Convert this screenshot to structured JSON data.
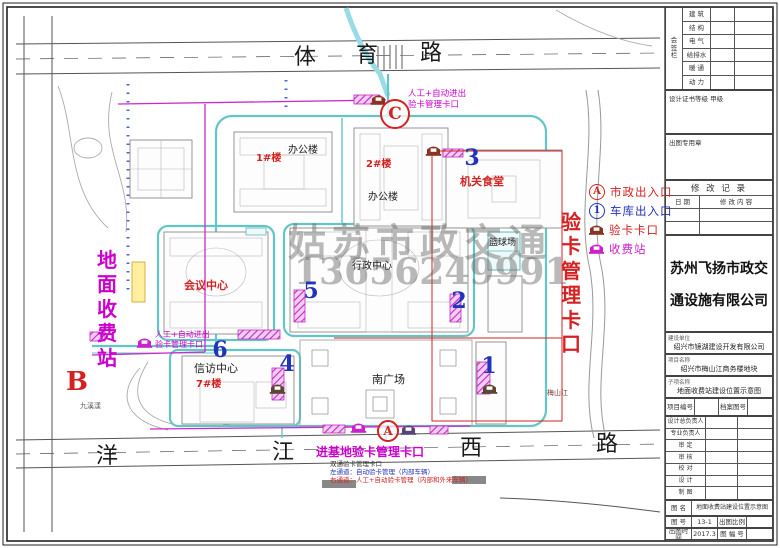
{
  "roads": {
    "top_name": "体育路",
    "bottom_name": "洋江西路"
  },
  "zones": {
    "left_vertical": "地面收费站",
    "right_vertical": "验卡管理卡口"
  },
  "watermark": {
    "text": "姑苏市政交通",
    "phone": "13656249991"
  },
  "legend": {
    "items": [
      {
        "symbol": "A",
        "shape": "circle",
        "color": "#d42222",
        "label": "市政出入口",
        "label_color": "#d42222"
      },
      {
        "symbol": "1",
        "shape": "circle",
        "color": "#2233bb",
        "label": "车库出入口",
        "label_color": "#2233bb"
      },
      {
        "symbol": "booth",
        "shape": "icon",
        "color": "#8a3322",
        "label": "验卡卡口",
        "label_color": "#d42222"
      },
      {
        "symbol": "booth",
        "shape": "icon",
        "color": "#cc22cc",
        "label": "收费站",
        "label_color": "#cc22cc"
      }
    ]
  },
  "labels": [
    {
      "name": "road-top-char-1",
      "text": "体",
      "x": 294,
      "y": 47,
      "s": 22
    },
    {
      "name": "road-top-char-2",
      "text": "育",
      "x": 356,
      "y": 45,
      "s": 22
    },
    {
      "name": "road-top-char-3",
      "text": "路",
      "x": 420,
      "y": 43,
      "s": 22
    },
    {
      "name": "road-bottom-char-1",
      "text": "洋",
      "x": 96,
      "y": 446,
      "s": 22
    },
    {
      "name": "road-bottom-char-2",
      "text": "江",
      "x": 272,
      "y": 442,
      "s": 22
    },
    {
      "name": "road-bottom-char-3",
      "text": "西",
      "x": 460,
      "y": 438,
      "s": 22
    },
    {
      "name": "road-bottom-char-4",
      "text": "路",
      "x": 596,
      "y": 434,
      "s": 22
    },
    {
      "name": "zone-ground-toll-station",
      "text": "地面收费站",
      "x": 96,
      "y": 248,
      "s": 20,
      "c": "#cc00cc",
      "v": true,
      "b": true
    },
    {
      "name": "zone-card-check-gate",
      "text": "验卡管理卡口",
      "x": 560,
      "y": 210,
      "s": 20,
      "c": "#d42222",
      "v": true,
      "b": true
    },
    {
      "name": "bldg-office-1-label",
      "text": "办公楼",
      "x": 288,
      "y": 146,
      "s": 10
    },
    {
      "name": "bldg-1-number",
      "text": "1#楼",
      "x": 256,
      "y": 154,
      "s": 10,
      "c": "#d42222",
      "b": true
    },
    {
      "name": "bldg-2-number",
      "text": "2#楼",
      "x": 366,
      "y": 160,
      "s": 10,
      "c": "#d42222",
      "b": true
    },
    {
      "name": "bldg-office-2-label",
      "text": "办公楼",
      "x": 368,
      "y": 193,
      "s": 10
    },
    {
      "name": "bldg-canteen",
      "text": "机关食堂",
      "x": 460,
      "y": 176,
      "s": 11,
      "c": "#d42222",
      "b": true
    },
    {
      "name": "bldg-conference-center",
      "text": "会议中心",
      "x": 184,
      "y": 280,
      "s": 11,
      "c": "#d42222",
      "b": true
    },
    {
      "name": "bldg-admin-center",
      "text": "行政中心",
      "x": 352,
      "y": 262,
      "s": 10
    },
    {
      "name": "bldg-basketball-court",
      "text": "篮球场",
      "x": 489,
      "y": 239,
      "s": 9
    },
    {
      "name": "bldg-petition-center",
      "text": "信访中心",
      "x": 194,
      "y": 363,
      "s": 11
    },
    {
      "name": "bldg-7-number",
      "text": "7#楼",
      "x": 196,
      "y": 380,
      "s": 10,
      "c": "#d42222",
      "b": true
    },
    {
      "name": "area-south-plaza",
      "text": "南广场",
      "x": 372,
      "y": 374,
      "s": 11
    },
    {
      "name": "river-meishanjiang",
      "text": "梅山江",
      "x": 547,
      "y": 390,
      "s": 7,
      "c": "#7a3a2a"
    },
    {
      "name": "pond-jiuxiyang",
      "text": "九溪漾",
      "x": 80,
      "y": 403,
      "s": 7,
      "c": "#555555"
    },
    {
      "name": "note-north-gate-line1",
      "text": "人工+自动进出",
      "x": 408,
      "y": 90,
      "s": 8.5,
      "c": "#cc00cc"
    },
    {
      "name": "note-north-gate-line2",
      "text": "验卡管理卡口",
      "x": 408,
      "y": 101,
      "s": 8.5,
      "c": "#cc00cc"
    },
    {
      "name": "note-west-gate-line1",
      "text": "人工+自动进出",
      "x": 155,
      "y": 331,
      "s": 8,
      "c": "#cc00cc"
    },
    {
      "name": "note-west-gate-line2",
      "text": "验卡管理卡口",
      "x": 155,
      "y": 341,
      "s": 8,
      "c": "#cc00cc"
    },
    {
      "name": "note-south-gate-title",
      "text": "进基地验卡管理卡口",
      "x": 316,
      "y": 446,
      "s": 12,
      "c": "#cc00cc",
      "b": true
    },
    {
      "name": "note-south-gate-sub",
      "text": "双通验卡管理卡口",
      "x": 330,
      "y": 461,
      "s": 6.5,
      "c": "#333333"
    },
    {
      "name": "note-south-gate-left-lane",
      "text": "左通道：自动验卡管理（内部车辆）",
      "x": 330,
      "y": 469,
      "s": 6.5,
      "c": "#2233bb"
    },
    {
      "name": "note-south-gate-right-lane",
      "text": "右通道：人工+自动验卡管理（内部和外来车辆）",
      "x": 330,
      "y": 477,
      "s": 6.5,
      "c": "#d42222"
    },
    {
      "name": "watermark-text",
      "text": "姑苏市政交通",
      "x": 288,
      "y": 224,
      "s": 38,
      "c": "rgba(100,100,100,0.45)",
      "b": true,
      "ls": 6,
      "serif": true
    },
    {
      "name": "watermark-phone",
      "text": "13656249991",
      "x": 294,
      "y": 254,
      "s": 36,
      "c": "rgba(100,100,100,0.45)",
      "b": true,
      "serif": true
    }
  ],
  "markers": [
    {
      "name": "marker-exit-c",
      "text": "C",
      "shape": "circle",
      "x": 395,
      "y": 114,
      "d": 26,
      "fs": 17,
      "color": "#d42222"
    },
    {
      "name": "marker-exit-a",
      "text": "A",
      "shape": "circle",
      "x": 388,
      "y": 431,
      "d": 18,
      "fs": 12,
      "color": "#d42222"
    },
    {
      "name": "marker-exit-b",
      "text": "B",
      "shape": "plain",
      "x": 77,
      "y": 382,
      "fs": 26,
      "color": "#d42222"
    },
    {
      "name": "marker-garage-1",
      "text": "1",
      "shape": "plain",
      "x": 489,
      "y": 366,
      "fs": 22,
      "color": "#2233bb"
    },
    {
      "name": "marker-garage-2",
      "text": "2",
      "shape": "plain",
      "x": 459,
      "y": 301,
      "fs": 22,
      "color": "#2233bb"
    },
    {
      "name": "marker-garage-3",
      "text": "3",
      "shape": "plain",
      "x": 472,
      "y": 158,
      "fs": 22,
      "color": "#2233bb"
    },
    {
      "name": "marker-garage-4",
      "text": "4",
      "shape": "plain",
      "x": 287,
      "y": 364,
      "fs": 22,
      "color": "#2233bb"
    },
    {
      "name": "marker-garage-5",
      "text": "5",
      "shape": "plain",
      "x": 311,
      "y": 291,
      "fs": 22,
      "color": "#2233bb"
    },
    {
      "name": "marker-garage-6",
      "text": "6",
      "shape": "plain",
      "x": 220,
      "y": 350,
      "fs": 22,
      "color": "#2233bb"
    }
  ],
  "titleblock": {
    "signature": {
      "col": "会签栏",
      "rows": [
        "建 筑",
        "结 构",
        "电 气",
        "给排水",
        "暖 通",
        "动 力"
      ]
    },
    "cert": "设计证书等级  甲级",
    "stamp": "出图专用章",
    "revision": {
      "title": "修 改 记 录",
      "col_date": "日 期",
      "col_desc": "修 改 内 容"
    },
    "company": [
      "苏州飞扬市政交",
      "通设施有限公司"
    ],
    "client": {
      "label": "建设单位",
      "value": "绍兴市镜湖建设开发有限公司"
    },
    "project": {
      "label": "项目名称",
      "value": "绍兴市梅山江商务楼地块"
    },
    "subitem": {
      "label": "子项名称",
      "value": "地面收费站建设位置示意图"
    },
    "ids": {
      "c1": "项目编号",
      "v1": "",
      "c2": "档案图号",
      "v2": ""
    },
    "persons": [
      "设计总负责人",
      "专业负责人",
      "审 定",
      "审 核",
      "校 对",
      "设 计",
      "制 图"
    ],
    "sheet_name": {
      "label": "图 名",
      "value": "地面收费站建设位置示意图"
    },
    "row_no": {
      "c1": "图 号",
      "v1": "13-1",
      "c2": "出图比例",
      "v2": ""
    },
    "row_date": {
      "c1": "出图时间",
      "v1": "2017.3",
      "c2": "图 幅 号",
      "v2": ""
    }
  }
}
